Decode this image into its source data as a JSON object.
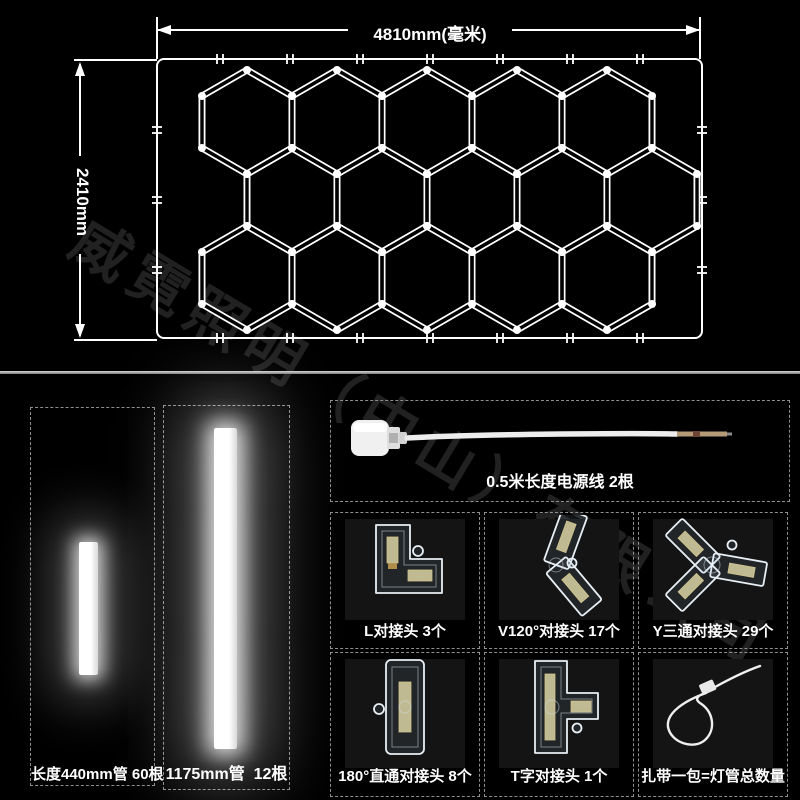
{
  "watermark": {
    "text": "威霓照明（中山）有限公司"
  },
  "diagram": {
    "width_label": "4810mm(毫米)",
    "height_label": "2410mm",
    "frame": {
      "x": 157,
      "y": 59,
      "w": 545,
      "h": 279,
      "corner_radius": 7
    },
    "hex_radius": 52,
    "hex_rows": [
      {
        "y": 122,
        "xs": [
          247,
          337,
          427,
          517,
          607
        ]
      },
      {
        "y": 200,
        "xs": [
          292,
          382,
          472,
          562,
          652
        ]
      },
      {
        "y": 278,
        "xs": [
          247,
          337,
          427,
          517,
          607
        ]
      }
    ],
    "line_color": "#ffffff",
    "background": "#000000"
  },
  "parts": {
    "tube_small": {
      "caption": "长度440mm管 60根"
    },
    "tube_large": {
      "caption": "1175mm管  12根"
    },
    "power_cable": {
      "caption": "0.5米长度电源线 2根",
      "tip_color": "#b49a76"
    },
    "connectors": [
      {
        "id": "l-connector",
        "caption": "L对接头 3个"
      },
      {
        "id": "v120-connector",
        "caption": "V120°对接头 17个"
      },
      {
        "id": "y-connector",
        "caption": "Y三通对接头 29个"
      },
      {
        "id": "straight-connector",
        "caption": "180°直通对接头 8个"
      },
      {
        "id": "t-connector",
        "caption": "T字对接头 1个"
      },
      {
        "id": "zip-tie",
        "caption": "扎带一包=灯管总数量"
      }
    ]
  },
  "colors": {
    "background": "#000000",
    "line": "#ffffff",
    "dashed_border": "#8f8f8f",
    "caption_text": "#ffffff",
    "separator": "#b5b5b5",
    "watermark": "rgba(255,255,255,0.13)",
    "cartridge": "#e9e0ae"
  }
}
